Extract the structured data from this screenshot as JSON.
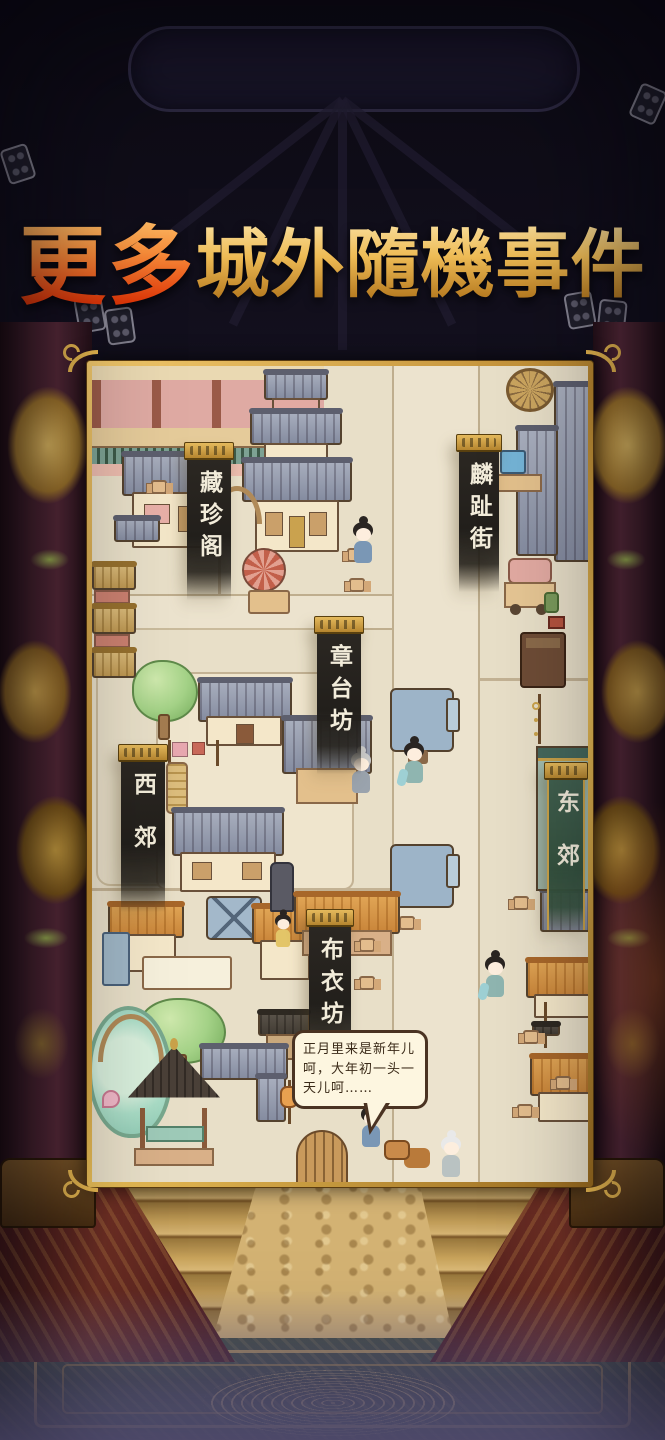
{
  "title": {
    "accent": "更多",
    "main": "城外隨機事件"
  },
  "map": {
    "district_banners": [
      {
        "id": "cangzhen-ge",
        "label": "藏珍阁"
      },
      {
        "id": "linzhi-jie",
        "label": "麟趾街"
      },
      {
        "id": "zhangtai-fang",
        "label": "章台坊"
      },
      {
        "id": "xi-jiao",
        "label": "西郊"
      },
      {
        "id": "dong-jiao",
        "label": "东郊"
      },
      {
        "id": "buyi-fang",
        "label": "布衣坊"
      }
    ],
    "speech_bubble": {
      "line1": "正月里来是新年儿",
      "line2": "呵，大年初一头一",
      "line3": "天儿呵……"
    }
  },
  "colors": {
    "title_gold": "#eebb55",
    "title_orange": "#e03708",
    "frame_gold": "#d9a944",
    "banner_black": "#221f1b",
    "banner_teal": "#3a5847",
    "map_ground": "#e8dfc8",
    "background_dark": "#141120"
  }
}
